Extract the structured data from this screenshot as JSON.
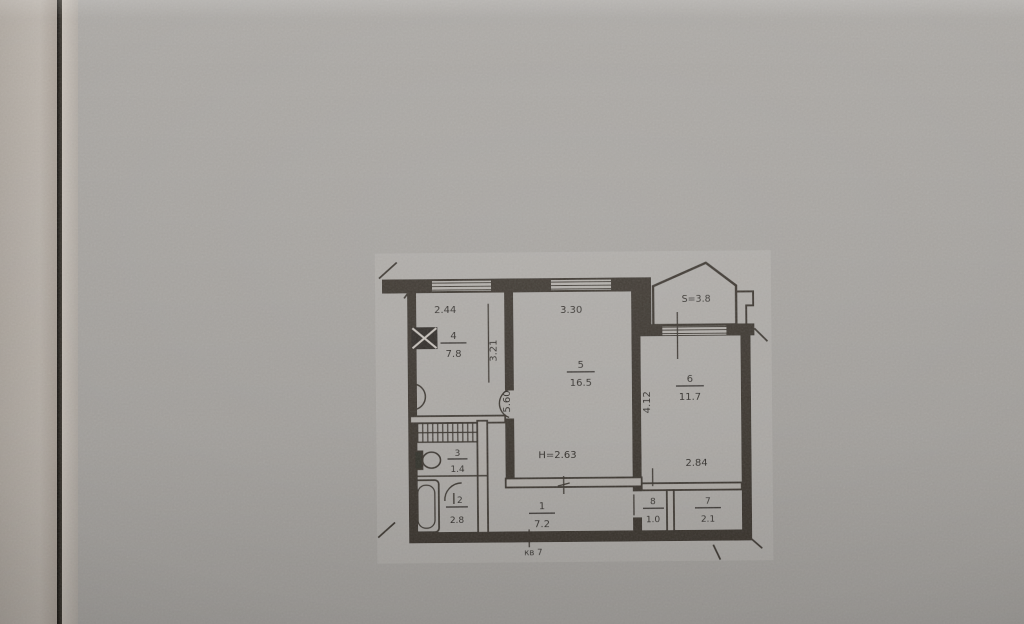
{
  "photo": {
    "colors": {
      "paper": "#a9a6a2",
      "adjacent_page": "#b9b2aa",
      "gap_shadow": "#14110e",
      "ink": "#39342e"
    }
  },
  "plan": {
    "apartment_label": "кв 7",
    "ceiling_height_label": "Н=2.63",
    "balcony_area_label": "S=3.8",
    "rooms": [
      {
        "number": "1",
        "area": "7.2"
      },
      {
        "number": "2",
        "area": "2.8"
      },
      {
        "number": "3",
        "area": "1.4"
      },
      {
        "number": "4",
        "area": "7.8"
      },
      {
        "number": "5",
        "area": "16.5"
      },
      {
        "number": "6",
        "area": "11.7"
      },
      {
        "number": "7",
        "area": "2.1"
      },
      {
        "number": "8",
        "area": "1.0"
      }
    ],
    "dimensions": {
      "room4_width": "2.44",
      "room4_depth": "3.21",
      "room5_width": "3.30",
      "room5_depth": "5.60",
      "room6_depth": "4.12",
      "room6_width": "2.84"
    },
    "icons": [
      "stove-icon",
      "sink-icon",
      "toilet-icon",
      "bathtub-icon",
      "window-glyph",
      "door-arc",
      "closet-hatch"
    ]
  }
}
